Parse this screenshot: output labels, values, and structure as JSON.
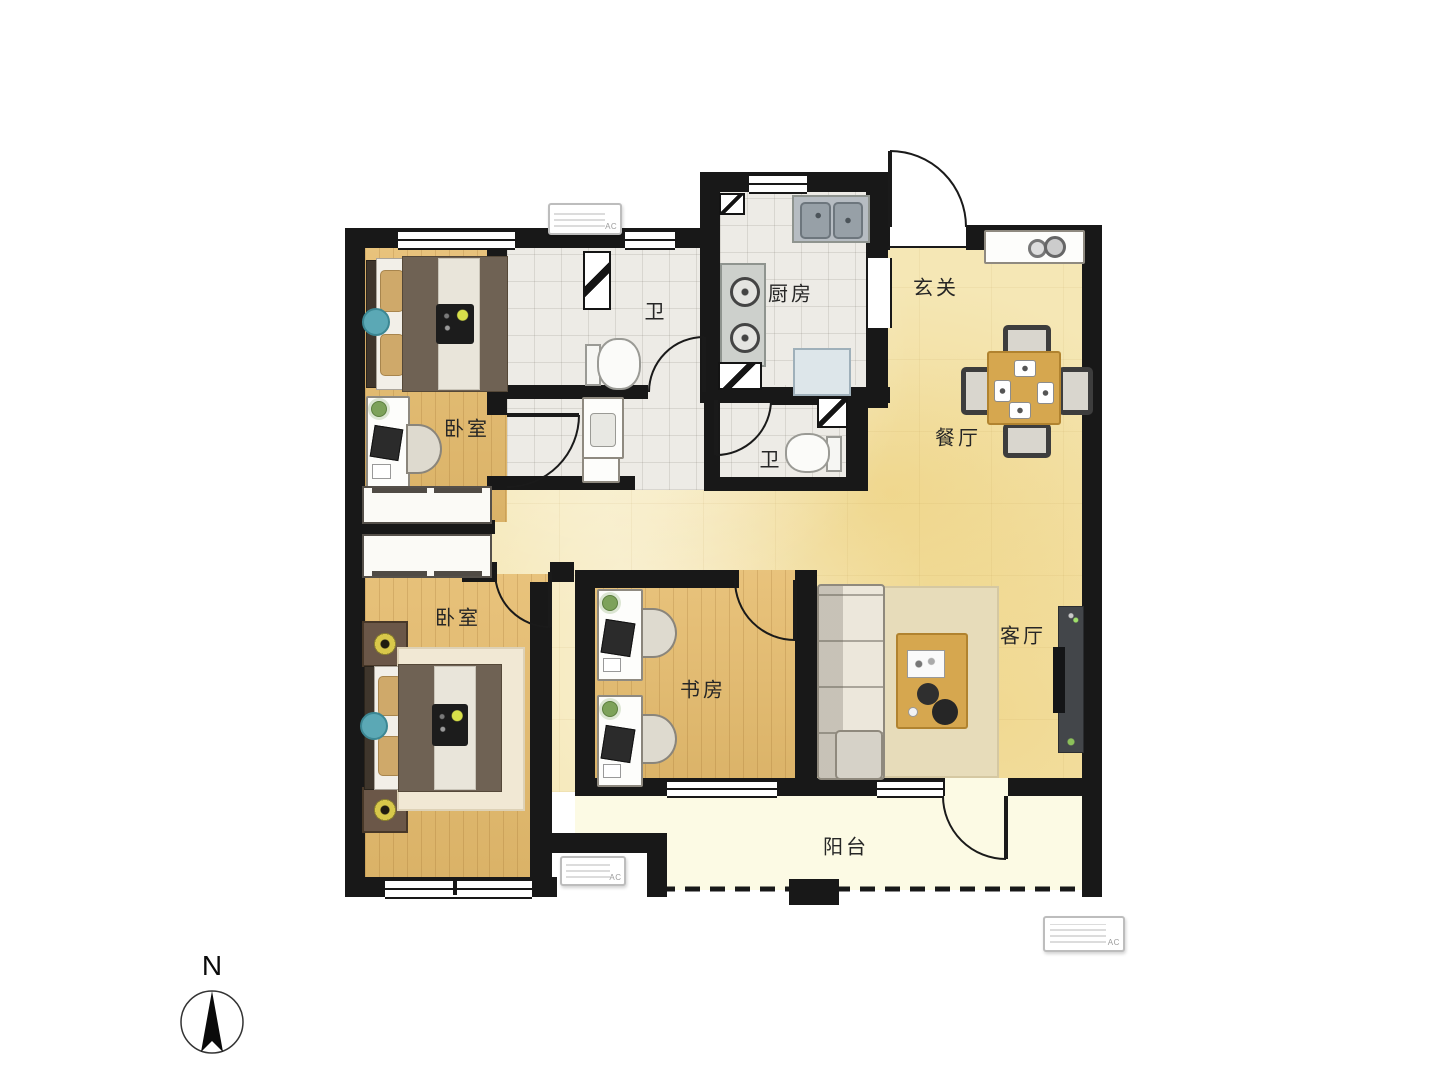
{
  "rooms": {
    "bedroom_top": {
      "label": "卧室"
    },
    "bath_top": {
      "label": "卫"
    },
    "kitchen": {
      "label": "厨房"
    },
    "entry": {
      "label": "玄关"
    },
    "dining": {
      "label": "餐厅"
    },
    "bath_mid": {
      "label": "卫"
    },
    "bedroom_bottom": {
      "label": "卧室"
    },
    "study": {
      "label": "书房"
    },
    "living": {
      "label": "客厅"
    },
    "balcony": {
      "label": "阳台"
    }
  },
  "compass": {
    "north_label": "N"
  },
  "ac": {
    "label": "AC"
  },
  "colors": {
    "wall": "#181818",
    "wood_floor": "#e6bc6d",
    "marble_floor": "#f5e7b5",
    "tile_floor": "#edebe6",
    "balcony_floor": "#fcfae4",
    "accent_table": "#d6a74f"
  }
}
